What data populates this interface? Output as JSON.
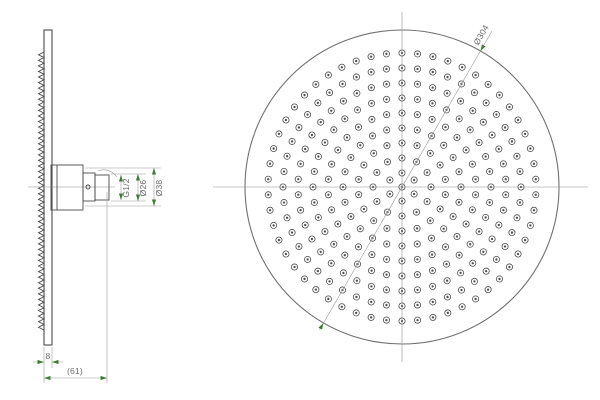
{
  "title": "Overhead shower head technical drawing, side and front views",
  "dimensions": {
    "outer_diameter": "Ø304",
    "thread_size": "G1/2",
    "connector_diameter": "Ø26",
    "flange_diameter": "Ø38",
    "plate_thickness": "8",
    "overall_depth": "(61)"
  },
  "colors": {
    "background": "#ffffff",
    "geometry": "#4a4a4a",
    "rim": "#707070",
    "centerline": "#8f8f8f",
    "dimension_line": "#9a9a9a",
    "arrow_green": "#3e7d36",
    "dimension_text": "#6b6b6b"
  },
  "front_view": {
    "cx": 402,
    "cy": 187,
    "rim_radius": 157,
    "ring_start_angle_deg": 90,
    "center_nozzle": true,
    "nozzle_outer_radius": 3.1,
    "nozzle_dot_radius": 1.15,
    "nozzle_rings": [
      {
        "radius": 14,
        "count": 6
      },
      {
        "radius": 29,
        "count": 12
      },
      {
        "radius": 44,
        "count": 18
      },
      {
        "radius": 59,
        "count": 24
      },
      {
        "radius": 74,
        "count": 30
      },
      {
        "radius": 89,
        "count": 36
      },
      {
        "radius": 104,
        "count": 42
      },
      {
        "radius": 119,
        "count": 48
      },
      {
        "radius": 134,
        "count": 54
      }
    ]
  },
  "side_view": {
    "zigzag": {
      "x": 44,
      "tip_x": 38.5,
      "y_start": 52,
      "y_end": 330,
      "teeth": 50
    }
  }
}
